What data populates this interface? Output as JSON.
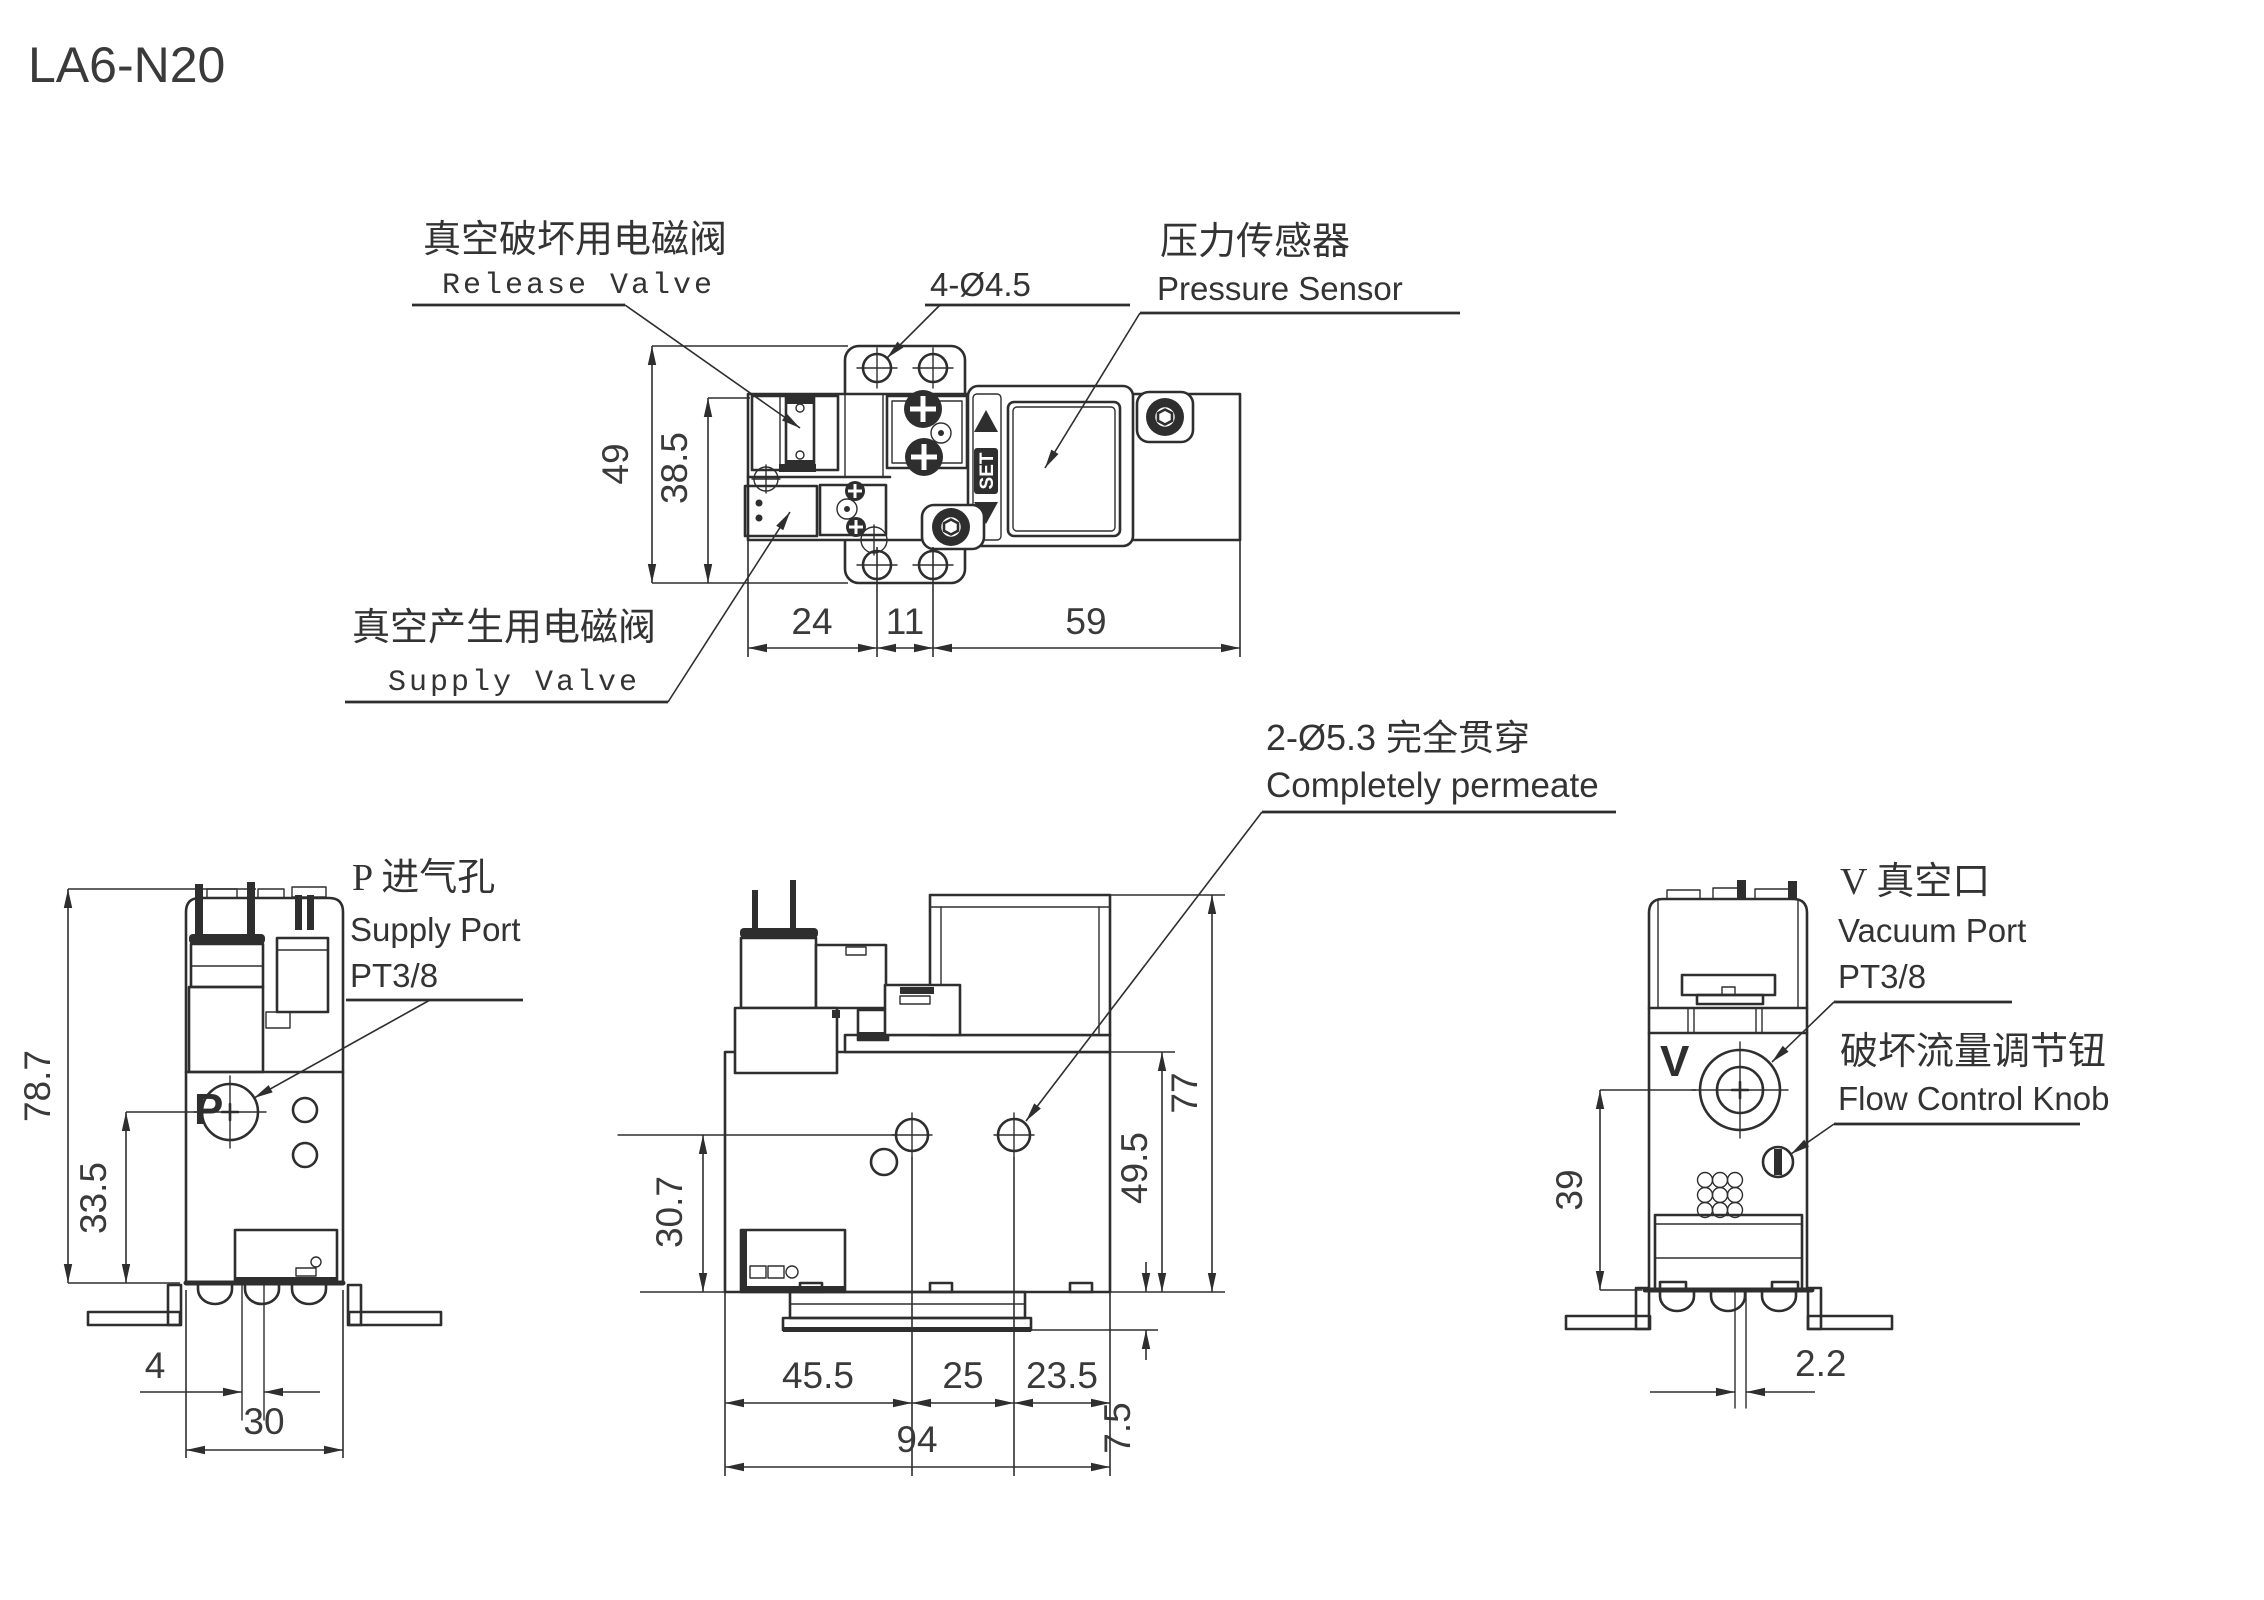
{
  "title": "LA6-N20",
  "views": {
    "top": {
      "labels": {
        "release_cn": "真空破坏用电磁阀",
        "release_en": "Release Valve",
        "holes": "4-Ø4.5",
        "sensor_cn": "压力传感器",
        "sensor_en": "Pressure Sensor",
        "supply_cn": "真空产生用电磁阀",
        "supply_en": "Supply Valve",
        "set_button": "SET"
      },
      "dims": {
        "overall_height": "49",
        "body_height": "38.5",
        "hole_offset": "24",
        "hole_pitch": "11",
        "sensor_width": "59"
      }
    },
    "left": {
      "labels": {
        "port_letter": "P",
        "port_cn": "P 进气孔",
        "port_en": "Supply Port",
        "thread": "PT3/8"
      },
      "dims": {
        "overall_height": "78.7",
        "port_center_height": "33.5",
        "port_offset": "4",
        "body_width": "30"
      }
    },
    "center": {
      "labels": {
        "holes_cn": "2-Ø5.3 完全贯穿",
        "holes_en": "Completely permeate"
      },
      "dims": {
        "overall_height": "77",
        "body_height": "49.5",
        "hole_center_height": "30.7",
        "hole_left_offset": "45.5",
        "hole_pitch": "25",
        "hole_right_offset": "23.5",
        "overall_width": "94",
        "plate_offset": "7.5"
      }
    },
    "right": {
      "labels": {
        "port_letter": "V",
        "port_cn": "V 真空口",
        "port_en": "Vacuum Port",
        "thread": "PT3/8",
        "knob_cn": "破坏流量调节钮",
        "knob_en": "Flow Control Knob"
      },
      "dims": {
        "port_center_height": "39",
        "port_offset": "2.2"
      }
    }
  }
}
